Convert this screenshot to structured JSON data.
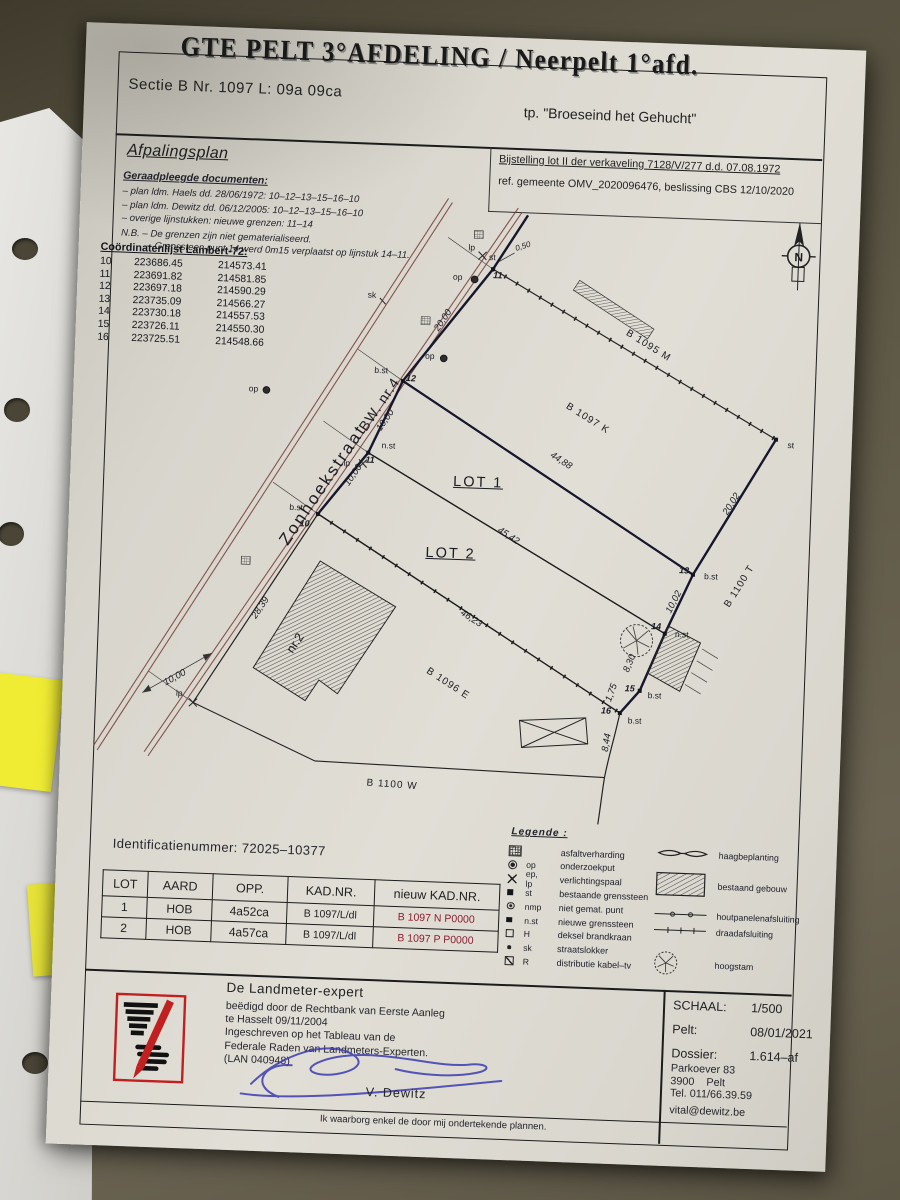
{
  "header": {
    "title": "GTE PELT 3°AFDELING / Neerpelt 1°afd.",
    "section": "Sectie B Nr. 1097 L: 09a 09ca",
    "toponym": "tp. \"Broeseind het Gehucht\"",
    "plan_title": "Afpalingsplan"
  },
  "notes": {
    "consulted_heading": "Geraadpleegde documenten:",
    "consulted": [
      "– plan ldm. Haels dd. 28/06/1972: 10–12–13–15–16–10",
      "– plan ldm. Dewitz dd. 06/12/2005: 10–12–13–15–16–10",
      "– overige lijnstukken: nieuwe grenzen: 11–14"
    ],
    "nb1": "N.B. – De grenzen zijn niet gematerialiseerd.",
    "nb2": "– Grenssteen punt 14 werd 0m15 verplaatst op lijnstuk 14–11.",
    "bijstelling1": "Bijstelling lot II der verkaveling 7128/V/277 d.d. 07.08.1972",
    "bijstelling2": "ref. gemeente OMV_2020096476, beslissing CBS 12/10/2020"
  },
  "coords": {
    "heading": "Coördinatenlijst Lambert-72:",
    "rows": [
      [
        "10",
        "223686.45",
        "214573.41"
      ],
      [
        "11",
        "223691.82",
        "214581.85"
      ],
      [
        "12",
        "223697.18",
        "214590.29"
      ],
      [
        "13",
        "223735.09",
        "214566.27"
      ],
      [
        "14",
        "223730.18",
        "214557.53"
      ],
      [
        "15",
        "223726.11",
        "214550.30"
      ],
      [
        "16",
        "223725.51",
        "214548.66"
      ]
    ]
  },
  "plan_labels": [
    {
      "t": "Zonhoekstraat",
      "x": 253,
      "y": 454,
      "r": -58,
      "c": "street"
    },
    {
      "t": "BW. nr.4",
      "x": 306,
      "y": 371,
      "r": -58,
      "c": "street2"
    },
    {
      "t": "20,00",
      "x": 367,
      "y": 285,
      "r": -58,
      "c": "m"
    },
    {
      "t": "10,00",
      "x": 313,
      "y": 387,
      "r": -58,
      "c": "m"
    },
    {
      "t": "10,00",
      "x": 283,
      "y": 443,
      "r": -58,
      "c": "m"
    },
    {
      "t": "28,39",
      "x": 195,
      "y": 579,
      "r": -58,
      "c": "m"
    },
    {
      "t": "10,00",
      "x": 112,
      "y": 652,
      "r": -31,
      "c": "m"
    },
    {
      "t": "44,88",
      "x": 490,
      "y": 421,
      "r": 31,
      "c": "m"
    },
    {
      "t": "45,42",
      "x": 440,
      "y": 498,
      "r": 31,
      "c": "m"
    },
    {
      "t": "46,23",
      "x": 406,
      "y": 582,
      "r": 31,
      "c": "m"
    },
    {
      "t": "20,02",
      "x": 662,
      "y": 458,
      "r": -60,
      "c": "m"
    },
    {
      "t": "10,02",
      "x": 608,
      "y": 558,
      "r": -65,
      "c": "m"
    },
    {
      "t": "8,30",
      "x": 566,
      "y": 621,
      "r": -70,
      "c": "m"
    },
    {
      "t": "1,75",
      "x": 549,
      "y": 651,
      "r": -72,
      "c": "m"
    },
    {
      "t": "8,44",
      "x": 546,
      "y": 701,
      "r": -83,
      "c": "m"
    },
    {
      "t": "0,50",
      "x": 444,
      "y": 208,
      "r": -20,
      "c": "ms"
    },
    {
      "t": "LOT 1",
      "x": 408,
      "y": 446,
      "r": 0,
      "c": "lot"
    },
    {
      "t": "LOT 2",
      "x": 383,
      "y": 518,
      "r": 0,
      "c": "lot"
    },
    {
      "t": "B 1095 M",
      "x": 573,
      "y": 303,
      "r": 30,
      "c": "parcel"
    },
    {
      "t": "B 1097 K",
      "x": 515,
      "y": 378,
      "r": 30,
      "c": "parcel"
    },
    {
      "t": "B 1096 E",
      "x": 385,
      "y": 648,
      "r": 31,
      "c": "parcel"
    },
    {
      "t": "B 1100 T",
      "x": 673,
      "y": 540,
      "r": -60,
      "c": "parcel"
    },
    {
      "t": "B 1100 W",
      "x": 333,
      "y": 751,
      "r": 2,
      "c": "parcel"
    },
    {
      "t": "nr.2",
      "x": 231,
      "y": 613,
      "r": -58,
      "c": "nr2"
    },
    {
      "t": "10",
      "x": 236,
      "y": 493,
      "r": 0,
      "c": "pt"
    },
    {
      "t": "11",
      "x": 299,
      "y": 427,
      "r": 0,
      "c": "pt"
    },
    {
      "t": "12",
      "x": 337,
      "y": 344,
      "r": 0,
      "c": "pt"
    },
    {
      "t": "13",
      "x": 617,
      "y": 526,
      "r": 0,
      "c": "pt"
    },
    {
      "t": "14",
      "x": 591,
      "y": 583,
      "r": 0,
      "c": "pt"
    },
    {
      "t": "15",
      "x": 567,
      "y": 646,
      "r": 0,
      "c": "pt"
    },
    {
      "t": "16",
      "x": 544,
      "y": 669,
      "r": 0,
      "c": "pt"
    },
    {
      "t": "11",
      "x": 420,
      "y": 238,
      "r": 0,
      "c": "pt"
    },
    {
      "t": "b.st",
      "x": 227,
      "y": 477,
      "r": 0,
      "c": "st"
    },
    {
      "t": "n.st",
      "x": 317,
      "y": 412,
      "r": 0,
      "c": "st"
    },
    {
      "t": "b.st",
      "x": 307,
      "y": 337,
      "r": 0,
      "c": "st"
    },
    {
      "t": "b.st",
      "x": 644,
      "y": 531,
      "r": 0,
      "c": "st"
    },
    {
      "t": "n.st",
      "x": 617,
      "y": 590,
      "r": 0,
      "c": "st"
    },
    {
      "t": "b.st",
      "x": 592,
      "y": 652,
      "r": 0,
      "c": "st"
    },
    {
      "t": "b.st",
      "x": 573,
      "y": 678,
      "r": 0,
      "c": "st"
    },
    {
      "t": "st",
      "x": 719,
      "y": 397,
      "r": 0,
      "c": "st"
    },
    {
      "t": "lp",
      "x": 393,
      "y": 211,
      "r": 0,
      "c": "st"
    },
    {
      "t": "st",
      "x": 414,
      "y": 220,
      "r": 0,
      "c": "st"
    },
    {
      "t": "op",
      "x": 380,
      "y": 241,
      "r": 0,
      "c": "st"
    },
    {
      "t": "op",
      "x": 180,
      "y": 360,
      "r": 0,
      "c": "st"
    },
    {
      "t": "op",
      "x": 355,
      "y": 321,
      "r": 0,
      "c": "st"
    },
    {
      "t": "lp",
      "x": 276,
      "y": 431,
      "r": 0,
      "c": "st"
    },
    {
      "t": "lp",
      "x": 117,
      "y": 667,
      "r": 0,
      "c": "st"
    },
    {
      "t": "sk",
      "x": 295,
      "y": 262,
      "r": 0,
      "c": "st"
    },
    {
      "t": "N",
      "x": 720,
      "y": 209,
      "r": 0,
      "c": "north"
    }
  ],
  "legend": {
    "heading": "Legende :",
    "left": [
      {
        "s": "hatch",
        "a": "",
        "l": "asfaltverharding"
      },
      {
        "s": "op",
        "a": "op",
        "l": "onderzoekput"
      },
      {
        "s": "lp",
        "a": "ep, lp",
        "l": "verlichtingspaal"
      },
      {
        "s": "st",
        "a": "st",
        "l": "bestaande grenssteen"
      },
      {
        "s": "nmp",
        "a": "nmp",
        "l": "niet gemat. punt"
      },
      {
        "s": "nst",
        "a": "n.st",
        "l": "nieuwe grenssteen"
      },
      {
        "s": "H",
        "a": "H",
        "l": "deksel brandkraan"
      },
      {
        "s": "sk",
        "a": "sk",
        "l": "straatslokker"
      },
      {
        "s": "R",
        "a": "R",
        "l": "distributie kabel–tv"
      }
    ],
    "right": [
      {
        "s": "haag",
        "l": "haagbeplanting"
      },
      {
        "s": "gebouw",
        "l": "bestaand gebouw"
      },
      {
        "s": "hout",
        "l": "houtpanelenafsluiting"
      },
      {
        "s": "draad",
        "l": "draadafsluiting"
      },
      {
        "s": "boom",
        "l": "hoogstam"
      }
    ]
  },
  "id_line": {
    "label": "Identificatienummer:",
    "value": "72025–10377"
  },
  "table": {
    "headers": [
      "LOT",
      "AARD",
      "OPP.",
      "KAD.NR.",
      "nieuw KAD.NR."
    ],
    "rows": [
      [
        "1",
        "HOB",
        "4a52ca",
        "B 1097/L/dl",
        "B 1097 N P0000"
      ],
      [
        "2",
        "HOB",
        "4a57ca",
        "B 1097/L/dl",
        "B 1097 P P0000"
      ]
    ],
    "new_kad_color": "#8a2030"
  },
  "footer": {
    "left": {
      "title": "De Landmeter-expert",
      "lines": [
        "beëdigd door de Rechtbank van Eerste Aanleg",
        "te Hasselt 09/11/2004",
        "Ingeschreven op het Tableau van de",
        "Federale Raden van Landmeters-Experten.",
        "(LAN 040948)"
      ],
      "signer": "V. Dewitz"
    },
    "right": {
      "rows": [
        [
          "SCHAAL:",
          "1/500"
        ],
        [
          "Pelt:",
          "08/01/2021"
        ],
        [
          "Dossier:",
          "1.614–af"
        ]
      ],
      "address": [
        "Parkoever 83",
        "3900    Pelt",
        "Tel. 011/66.39.59"
      ],
      "email": "vital@dewitz.be"
    },
    "guarantee": "Ik waarborg enkel de door mij ondertekende plannen."
  },
  "colors": {
    "street_line": "#7a4640",
    "boundary_bold": "#16162c",
    "point_number_blue": "#4f86b8",
    "new_kad_red": "#8a2030",
    "logo_red": "#c02020",
    "signature_blue": "#3b3bb0",
    "sticky_yellow": "#f0ec34"
  }
}
